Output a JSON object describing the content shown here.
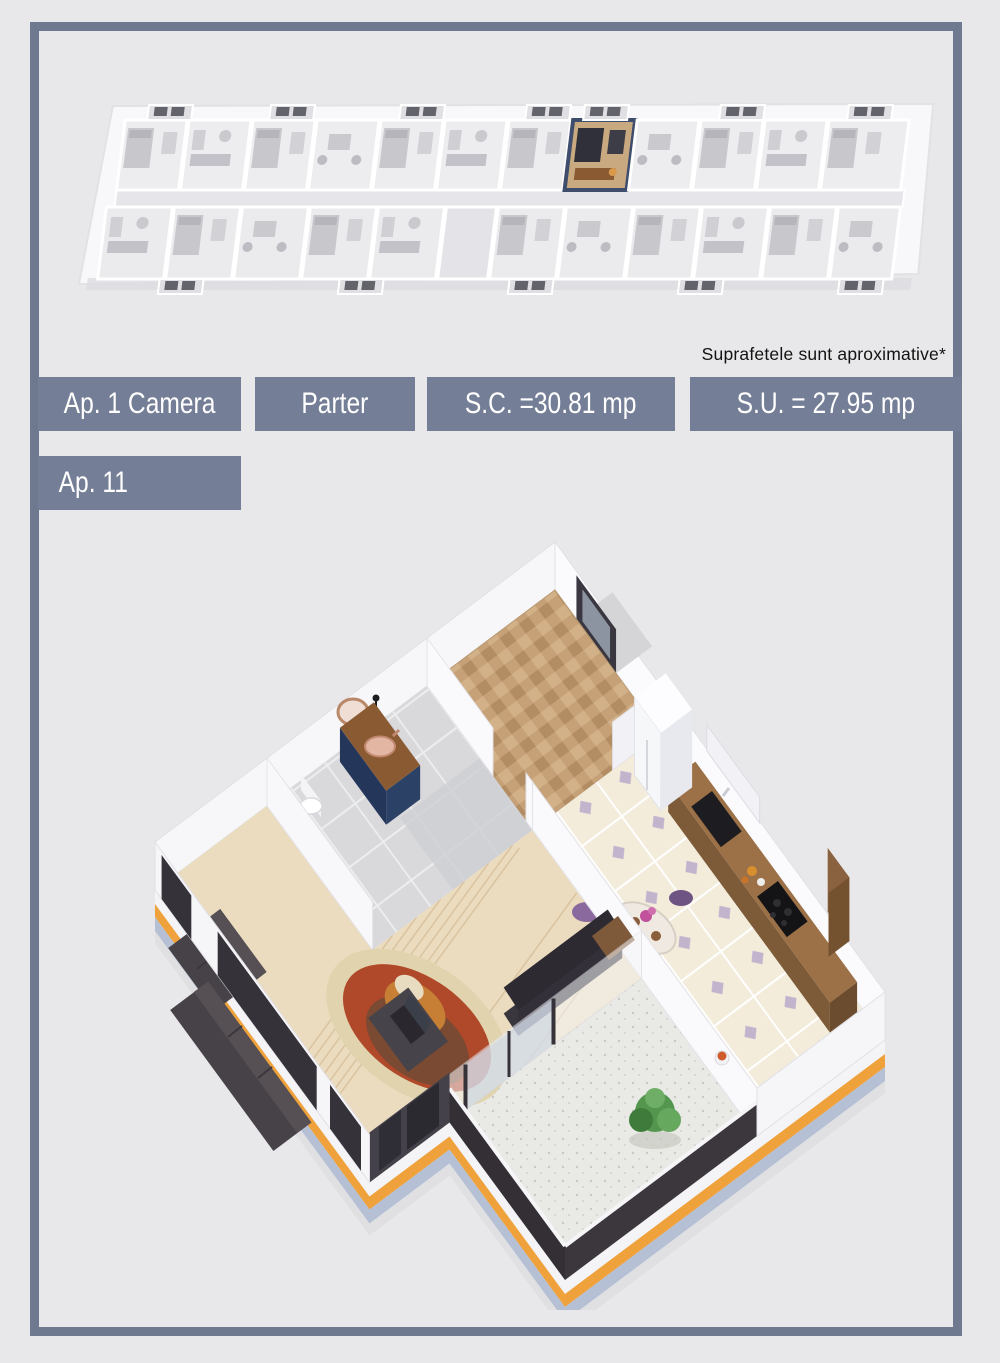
{
  "page": {
    "background": "#e8e8ea",
    "frame_color": "#6e7990",
    "note": "Suprafetele sunt aproximative*"
  },
  "labels": {
    "unit_type": "Ap. 1 Camera",
    "floor": "Parter",
    "built_area": "S.C. =30.81 mp",
    "usable_area": "S.U. = 27.95 mp",
    "unit_number": "Ap. 11"
  },
  "colors": {
    "label_bg": "#747e96",
    "label_text": "#ffffff",
    "facade_accent_orange": "#efa23c",
    "facade_dark_panel": "#36323a",
    "plinth_blue": "#b5c0d4",
    "highlight_unit_wall": "#3f4d6d",
    "highlight_unit_floor": "#c9aa80",
    "herringbone_wood": "#c6a178",
    "plank_wood": "#ecdcbf",
    "kitchen_tile": "#f3ecdb",
    "tile_diamond_accent": "#b7a6c9",
    "vanity_navy": "#2c4166",
    "vanity_wood": "#8a5a33",
    "copper_sink": "#e3b6a4",
    "sofa_charcoal": "#474247",
    "rug_rust": "#b0482a",
    "rug_brown": "#7a4a32",
    "rug_cream": "#e0d3ae",
    "plant_green": "#55964f",
    "chair_purple": "#7b5f91"
  }
}
